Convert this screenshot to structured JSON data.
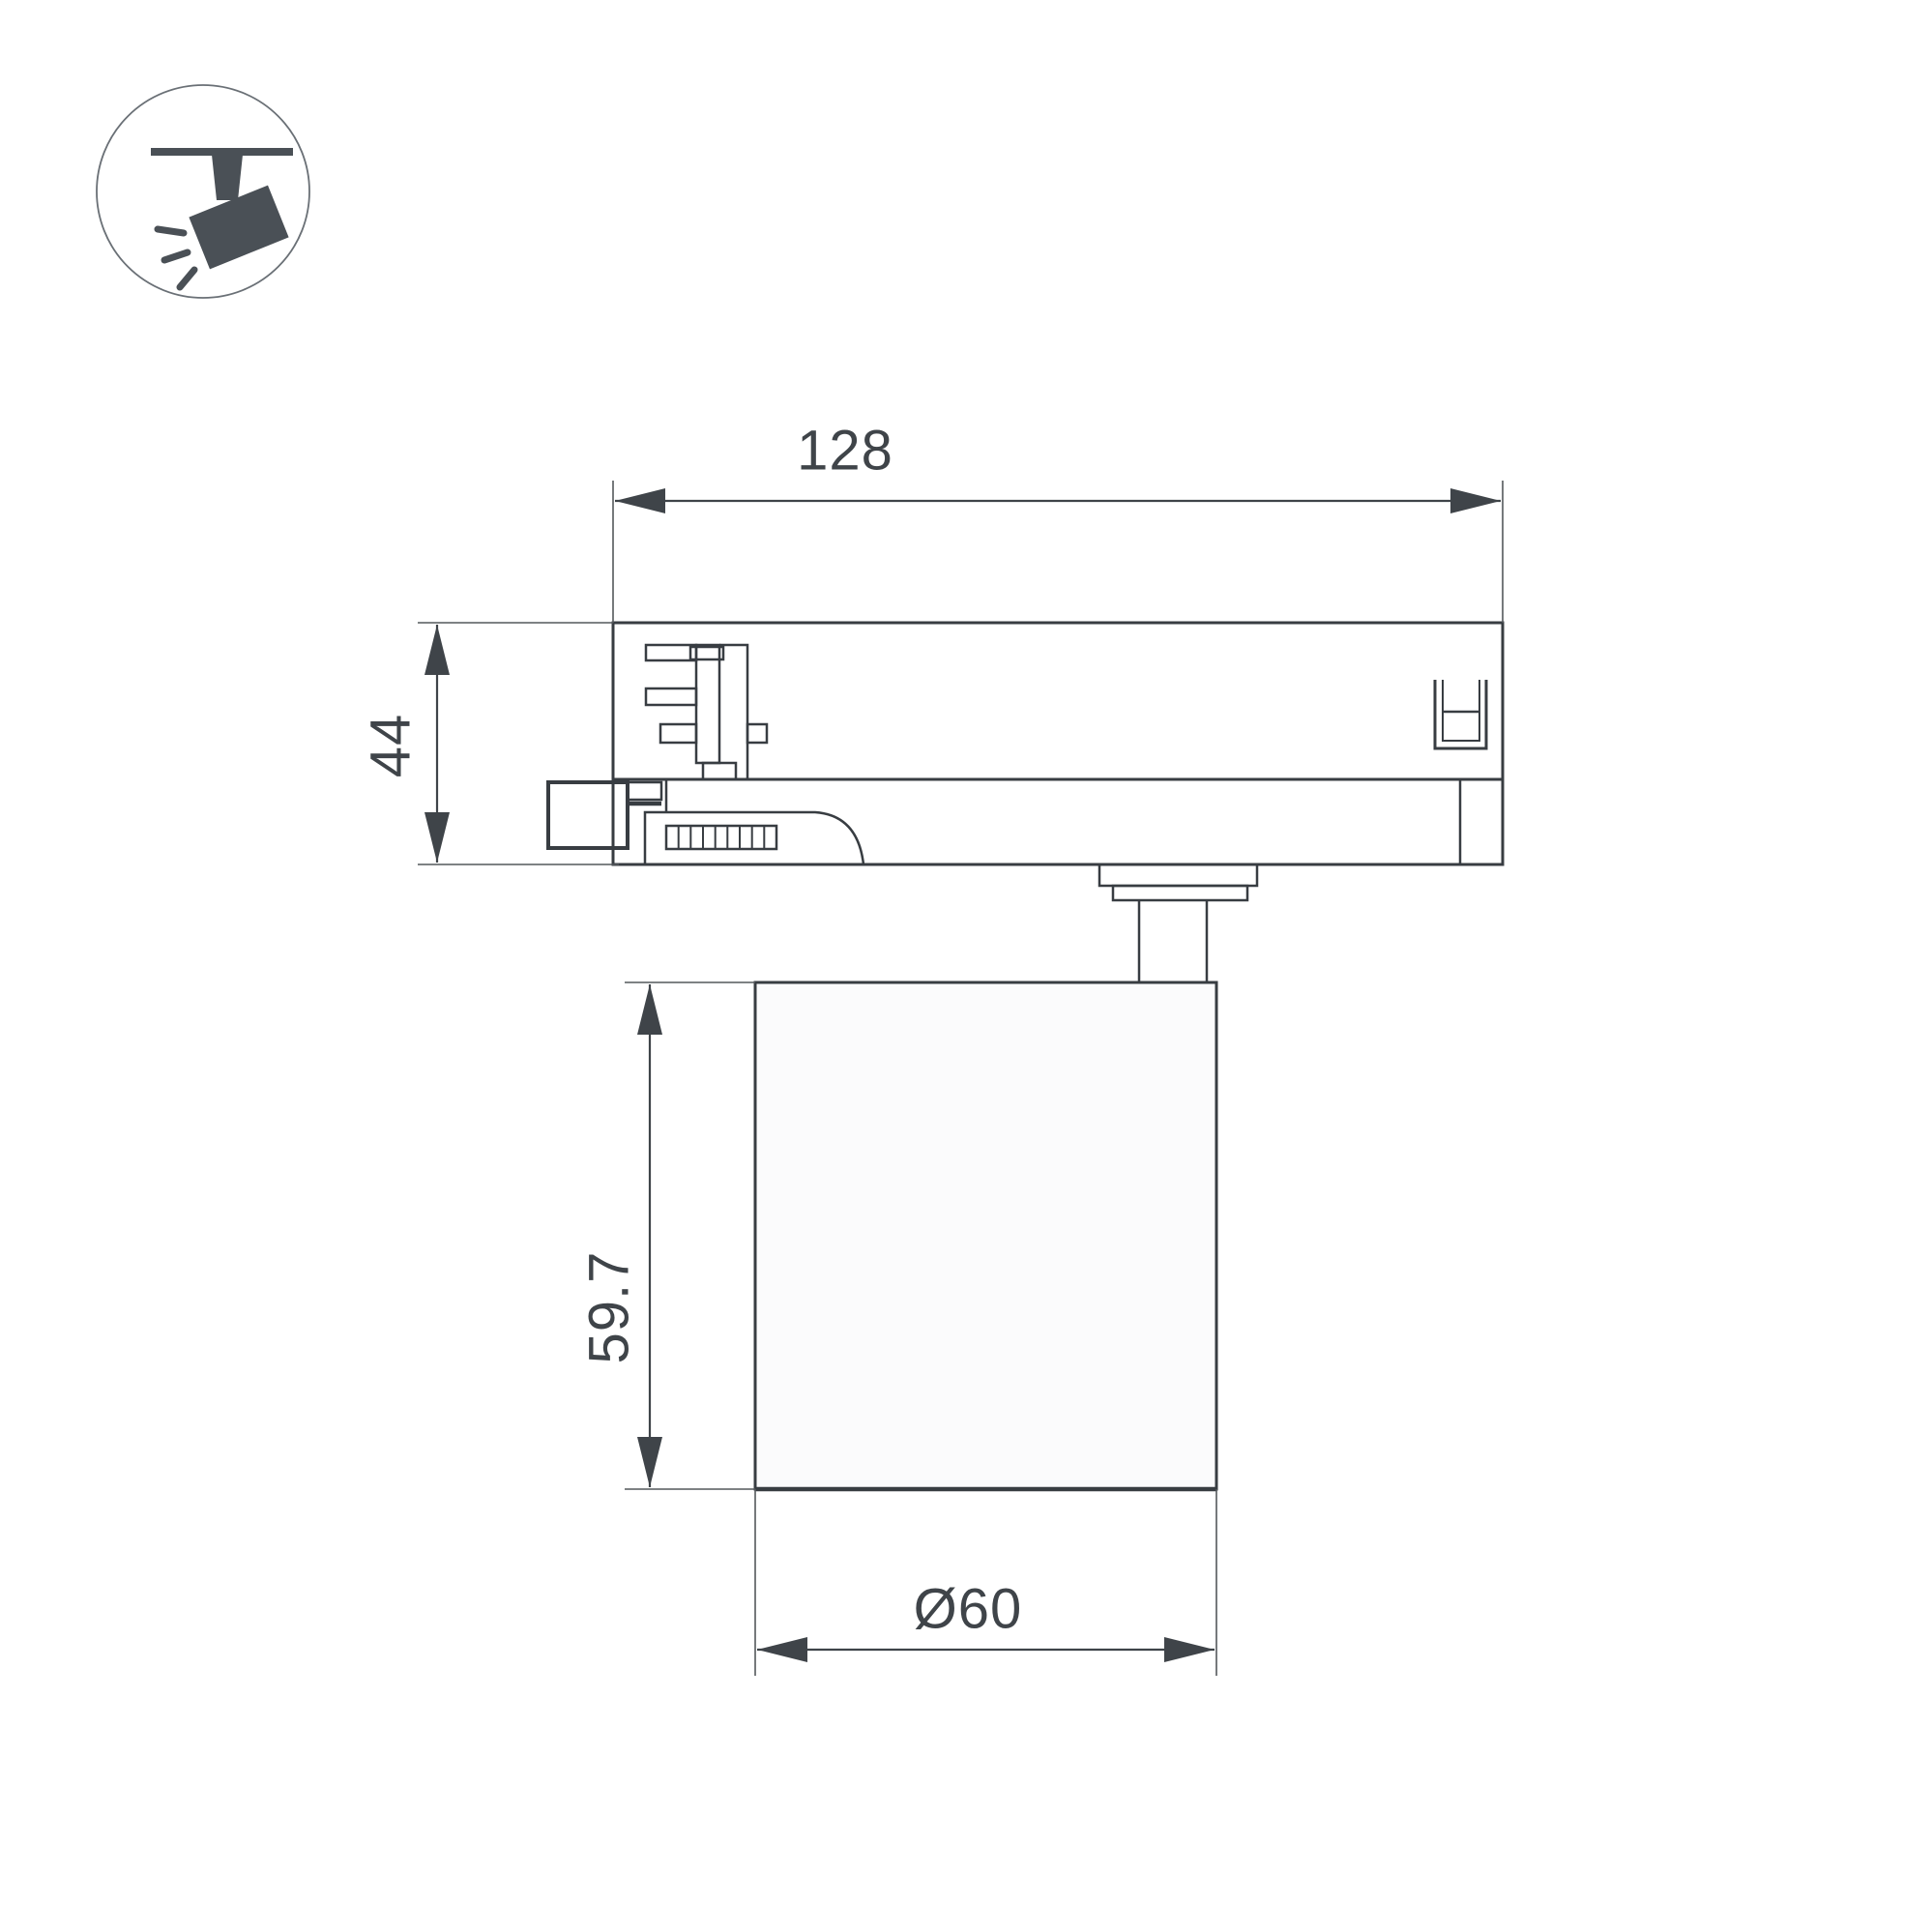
{
  "drawing": {
    "type": "technical-dimension-drawing",
    "subject": "track-mounted spotlight, side view with mm dimensions",
    "labels": {
      "width": "128",
      "adapter_height": "44",
      "body_height": "59.7",
      "body_diameter": "Ø60"
    },
    "colors": {
      "line": "#383d42",
      "thin_line": "#54585c",
      "text": "#3f4449",
      "icon": "#4a5056",
      "lamp_fill": "#fbfbfc",
      "background": "#ffffff"
    },
    "icon": {
      "name": "track-spotlight-icon"
    }
  }
}
